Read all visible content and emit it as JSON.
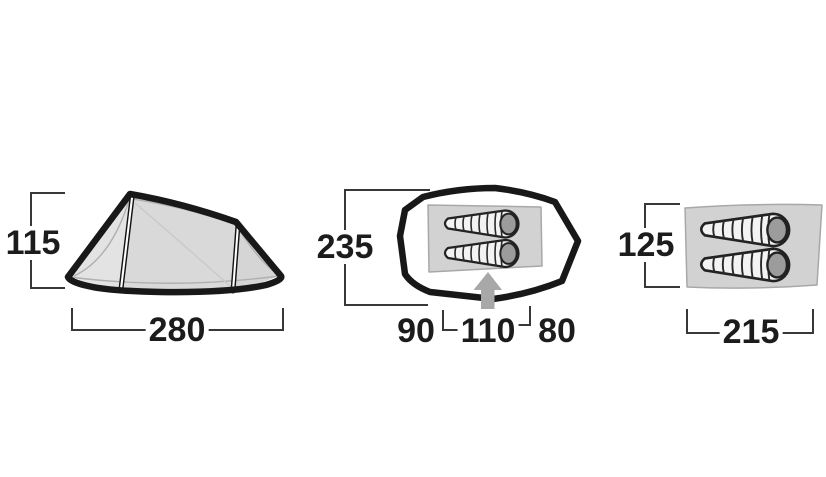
{
  "figures": {
    "side_view": {
      "icon": "tent-side-view",
      "height": "115",
      "width": "280"
    },
    "footprint": {
      "icon": "tent-footprint-top-view",
      "depth": "235",
      "width_left": "90",
      "width_entrance": "110",
      "width_right": "80",
      "entrance_icon": "up-arrow"
    },
    "inner_tent": {
      "icon": "inner-tent-floor-top-view",
      "height": "125",
      "width": "215",
      "pads_icon": "sleeping-pad"
    }
  },
  "colors": {
    "background": "#ffffff",
    "outline": "#181818",
    "dimension_line": "#383838",
    "dimension_text": "#1c1c1c",
    "fabric_fill": "#d9d9d9",
    "floor_fill": "#d2d2d2",
    "pad_head_fill": "#9c9c9c",
    "entrance_arrow_fill": "#a8a8a8"
  }
}
